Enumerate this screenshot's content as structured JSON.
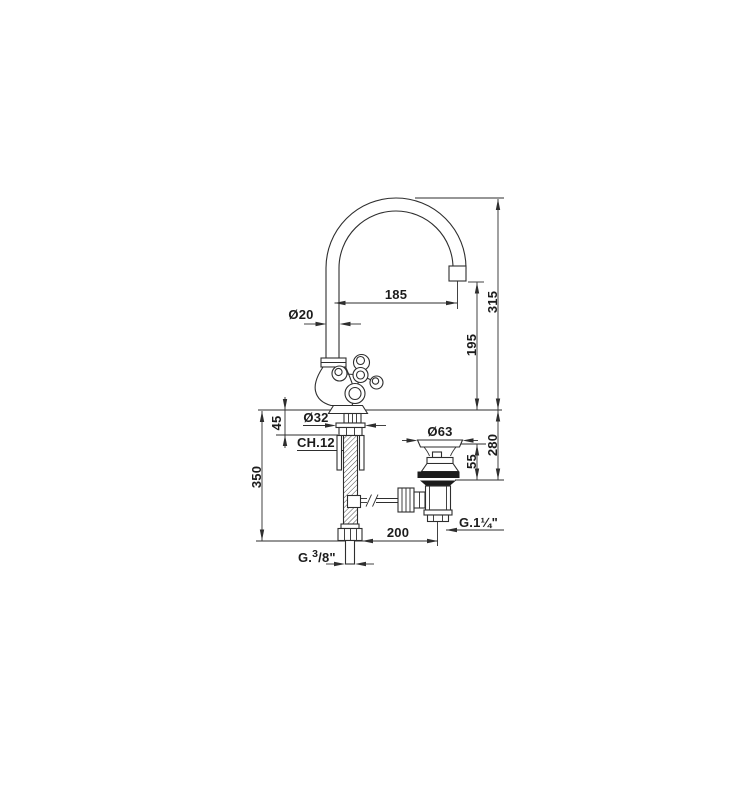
{
  "meta": {
    "drawing_type": "faucet-technical-dimension-drawing",
    "background_color": "#ffffff",
    "line_color": "#2e2e2e",
    "text_color": "#1c1c1c",
    "gasket_fill_color": "#1b1b1b"
  },
  "dimensions": {
    "spout_reach": "185",
    "spout_tube_diameter": "Ø20",
    "height_above_deck": "315",
    "spout_outlet_height": "195",
    "max_deck_thickness": "45",
    "shank_diameter": "Ø32",
    "wrench_size": "CH.12",
    "hose_length": "350",
    "waste_flange_diameter": "Ø63",
    "below_deck_depth": "280",
    "waste_clamp_range": "55",
    "waste_thread": "G.1¼\"",
    "waste_horizontal_offset": "200",
    "supply_thread_prefix": "G.",
    "supply_thread_sup": "3",
    "supply_thread_rest": "/8\""
  }
}
